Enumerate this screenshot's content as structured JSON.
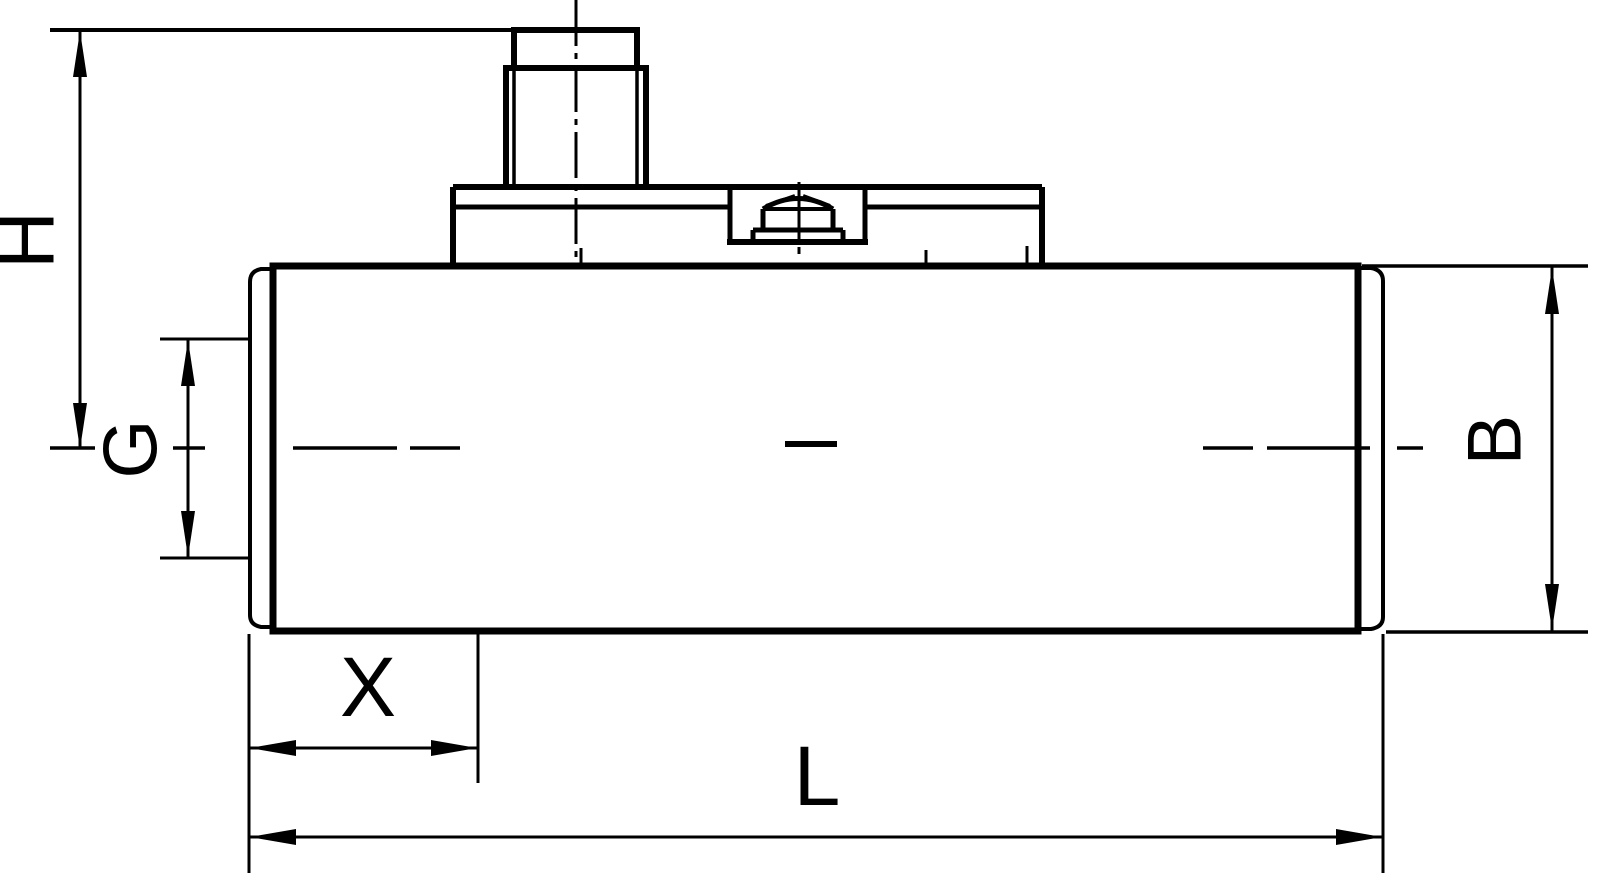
{
  "colors": {
    "line": "#000000",
    "background": "#ffffff"
  },
  "labels": {
    "h": "H",
    "g": "G",
    "b": "B",
    "x": "X",
    "l": "L"
  }
}
